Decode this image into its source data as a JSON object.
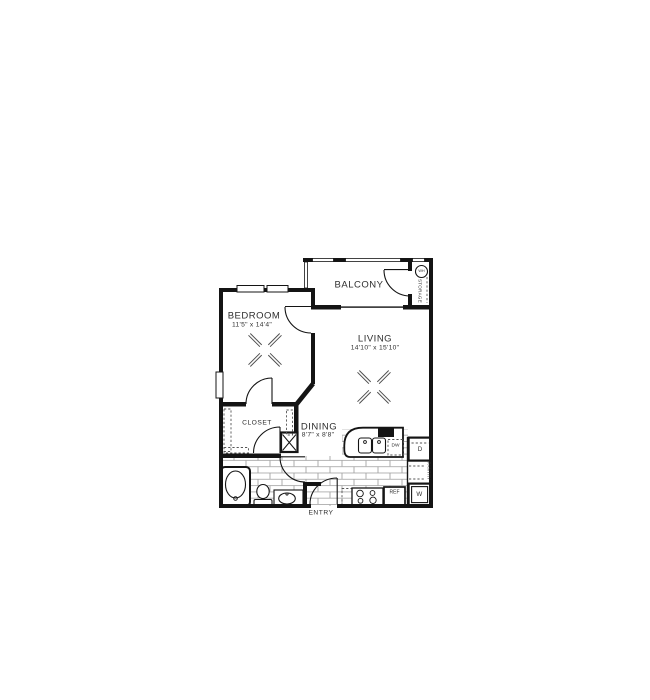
{
  "plan": {
    "rooms": {
      "balcony": {
        "label": "BALCONY"
      },
      "bedroom": {
        "label": "BEDROOM",
        "dims": "11'5\" x 14'4\""
      },
      "living": {
        "label": "LIVING",
        "dims": "14'10\" x 15'10\""
      },
      "dining": {
        "label": "DINING",
        "dims": "8'7\" x 8'8\""
      },
      "closet": {
        "label": "CLOSET"
      },
      "entry": {
        "label": "ENTRY"
      },
      "storage": {
        "label": "STORAGE"
      },
      "pantry": {
        "label": "PANTRY"
      }
    },
    "labels": {
      "water_heater": "WH",
      "dishwasher": "DW",
      "refrigerator": "REF",
      "dryer": "D",
      "washer": "W"
    },
    "colors": {
      "wall": "#141414",
      "text": "#2e2e2e",
      "tile_line": "#9a9a9a",
      "background": "#ffffff"
    }
  }
}
